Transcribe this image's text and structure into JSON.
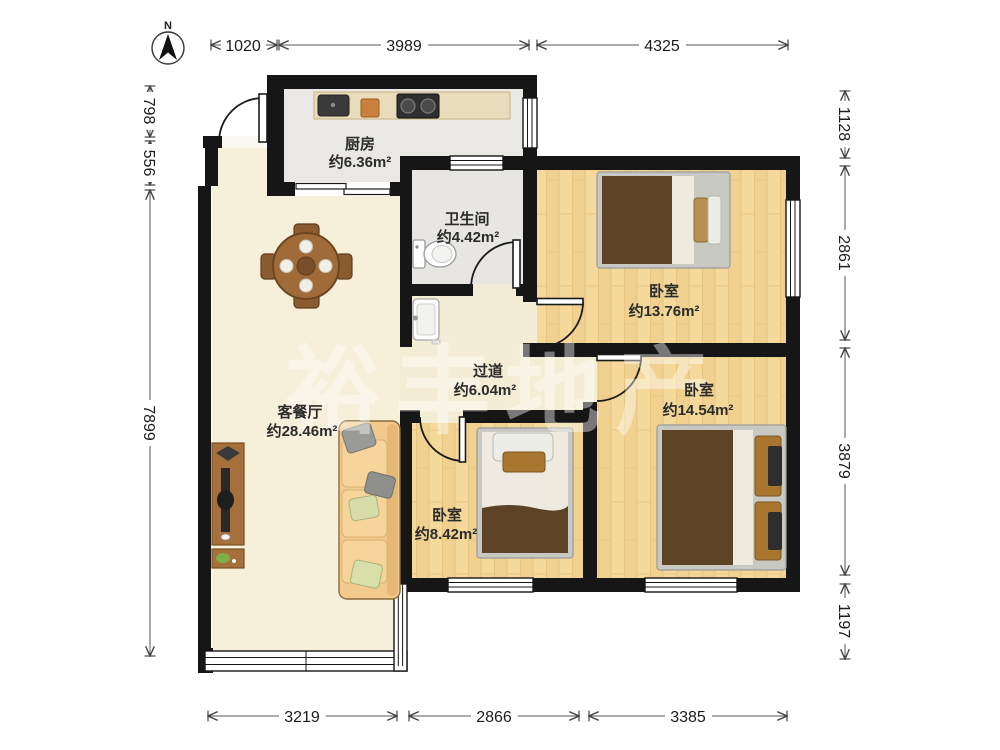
{
  "compass": {
    "north_label": "N"
  },
  "watermark": "裕丰地产",
  "rooms": {
    "kitchen": {
      "name": "厨房",
      "area": "约6.36m²"
    },
    "bathroom": {
      "name": "卫生间",
      "area": "约4.42m²"
    },
    "bedroom_top": {
      "name": "卧室",
      "area": "约13.76m²"
    },
    "bedroom_right": {
      "name": "卧室",
      "area": "约14.54m²"
    },
    "bedroom_bottom": {
      "name": "卧室",
      "area": "约8.42m²"
    },
    "hallway": {
      "name": "过道",
      "area": "约6.04m²"
    },
    "living_dining": {
      "name": "客餐厅",
      "area": "约28.46m²"
    }
  },
  "dimensions_mm": {
    "top": [
      "1020",
      "3989",
      "4325"
    ],
    "left": [
      "798",
      "556",
      "7899"
    ],
    "right": [
      "1128",
      "2861",
      "3879",
      "1197"
    ],
    "bottom": [
      "3219",
      "2866",
      "3385"
    ]
  },
  "colors": {
    "wall": "#161616",
    "wood_floor": "#F4D99B",
    "tile_floor": "#E9E8E5",
    "marble_floor": "#F6EFDA",
    "counter": "#E9DCBA",
    "blanket_brown": "#5C4326",
    "sofa_tan": "#F2CA8E",
    "dimension_text": "#1c1c1c"
  }
}
